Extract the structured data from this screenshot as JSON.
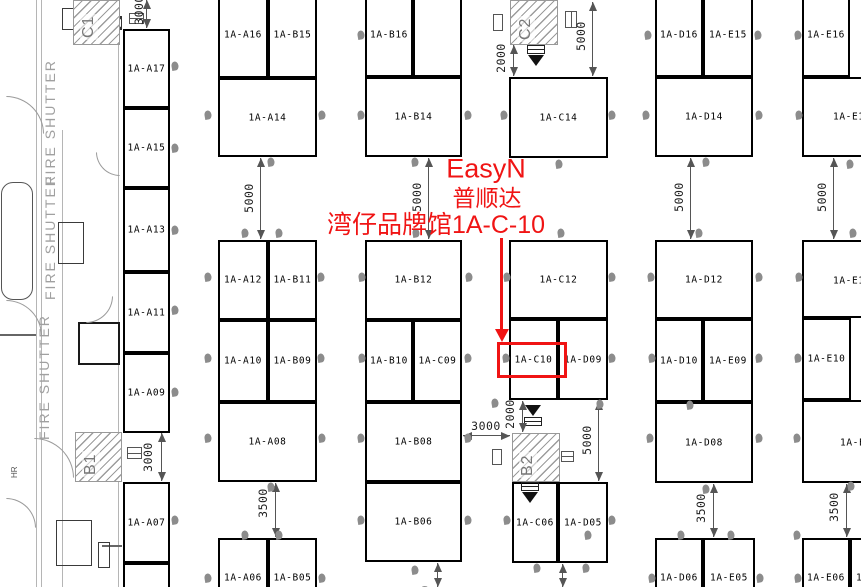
{
  "annotation": {
    "color": "#f01414",
    "lines": [
      {
        "text": "EasyN",
        "cx": 486,
        "cy": 169,
        "fs": 27
      },
      {
        "text": "普顺达",
        "cx": 487,
        "cy": 196,
        "fs": 23
      },
      {
        "text": "湾仔品牌馆1A-C-10",
        "cx": 436,
        "cy": 223,
        "fs": 25
      }
    ],
    "arrow": {
      "x": 500,
      "y1": 238,
      "y2": 330
    },
    "rect": {
      "x": 497,
      "y": 342,
      "w": 70,
      "h": 36
    },
    "highlight_booth": "1A-C10"
  },
  "fire_shutter_label": "FIRE SHUTTER",
  "fire_shutters": [
    {
      "x": 42,
      "y": 185
    },
    {
      "x": 42,
      "y": 300
    },
    {
      "x": 36,
      "y": 440
    }
  ],
  "hr": {
    "x": 10,
    "y": 478,
    "label": "HR"
  },
  "rooms": [
    {
      "label": "C1",
      "x": 73,
      "y": 0,
      "w": 47,
      "h": 45,
      "lx": 80,
      "ly": 40
    },
    {
      "label": "C2",
      "x": 510,
      "y": 0,
      "w": 48,
      "h": 45,
      "lx": 517,
      "ly": 42
    },
    {
      "label": "B1",
      "x": 75,
      "y": 432,
      "w": 47,
      "h": 50,
      "lx": 82,
      "ly": 477
    },
    {
      "label": "B2",
      "x": 512,
      "y": 433,
      "w": 48,
      "h": 49,
      "lx": 519,
      "ly": 478
    }
  ],
  "booths": [
    {
      "label": "1A-A17",
      "x": 123,
      "y": 29,
      "w": 47,
      "h": 79
    },
    {
      "label": "1A-A15",
      "x": 123,
      "y": 108,
      "w": 47,
      "h": 80
    },
    {
      "label": "1A-A13",
      "x": 123,
      "y": 188,
      "w": 47,
      "h": 84
    },
    {
      "label": "1A-A11",
      "x": 123,
      "y": 272,
      "w": 47,
      "h": 81
    },
    {
      "label": "1A-A09",
      "x": 123,
      "y": 353,
      "w": 47,
      "h": 80
    },
    {
      "label": "1A-A07",
      "x": 123,
      "y": 482,
      "w": 47,
      "h": 81
    },
    {
      "label": "",
      "x": 123,
      "y": 563,
      "w": 47,
      "h": 40
    },
    {
      "label": "1A-A16",
      "x": 218,
      "y": -8,
      "w": 50,
      "h": 86
    },
    {
      "label": "1A-B15",
      "x": 268,
      "y": -8,
      "w": 49,
      "h": 86
    },
    {
      "label": "1A-A14",
      "x": 218,
      "y": 78,
      "w": 99,
      "h": 79
    },
    {
      "label": "1A-A12",
      "x": 218,
      "y": 240,
      "w": 50,
      "h": 80
    },
    {
      "label": "1A-B11",
      "x": 268,
      "y": 240,
      "w": 49,
      "h": 80
    },
    {
      "label": "1A-A10",
      "x": 218,
      "y": 320,
      "w": 50,
      "h": 82
    },
    {
      "label": "1A-B09",
      "x": 268,
      "y": 320,
      "w": 49,
      "h": 82
    },
    {
      "label": "1A-A08",
      "x": 218,
      "y": 402,
      "w": 99,
      "h": 80
    },
    {
      "label": "1A-A06",
      "x": 218,
      "y": 538,
      "w": 50,
      "h": 60,
      "ly": 578
    },
    {
      "label": "1A-B05",
      "x": 268,
      "y": 538,
      "w": 49,
      "h": 60,
      "ly": 578
    },
    {
      "label": "1A-B16",
      "x": 365,
      "y": -8,
      "w": 48,
      "h": 85
    },
    {
      "label": "",
      "x": 413,
      "y": -8,
      "w": 49,
      "h": 85
    },
    {
      "label": "1A-B14",
      "x": 365,
      "y": 77,
      "w": 97,
      "h": 80
    },
    {
      "label": "1A-B12",
      "x": 365,
      "y": 240,
      "w": 97,
      "h": 80
    },
    {
      "label": "1A-B10",
      "x": 365,
      "y": 320,
      "w": 48,
      "h": 82
    },
    {
      "label": "1A-C09",
      "x": 413,
      "y": 320,
      "w": 49,
      "h": 82
    },
    {
      "label": "1A-B08",
      "x": 365,
      "y": 402,
      "w": 97,
      "h": 80
    },
    {
      "label": "1A-B06",
      "x": 365,
      "y": 482,
      "w": 97,
      "h": 80
    },
    {
      "label": "1A-C14",
      "x": 509,
      "y": 77,
      "w": 99,
      "h": 81
    },
    {
      "label": "1A-C12",
      "x": 509,
      "y": 240,
      "w": 99,
      "h": 79
    },
    {
      "label": "1A-C10",
      "x": 509,
      "y": 319,
      "w": 49,
      "h": 81
    },
    {
      "label": "1A-D09",
      "x": 558,
      "y": 319,
      "w": 50,
      "h": 81
    },
    {
      "label": "1A-C06",
      "x": 512,
      "y": 482,
      "w": 46,
      "h": 81
    },
    {
      "label": "1A-D05",
      "x": 558,
      "y": 482,
      "w": 50,
      "h": 81
    },
    {
      "label": "1A-D16",
      "x": 655,
      "y": -8,
      "w": 48,
      "h": 85
    },
    {
      "label": "1A-E15",
      "x": 703,
      "y": -8,
      "w": 50,
      "h": 85
    },
    {
      "label": "1A-D14",
      "x": 655,
      "y": 77,
      "w": 98,
      "h": 80
    },
    {
      "label": "1A-D12",
      "x": 655,
      "y": 240,
      "w": 98,
      "h": 79
    },
    {
      "label": "1A-D10",
      "x": 655,
      "y": 319,
      "w": 48,
      "h": 83
    },
    {
      "label": "1A-E09",
      "x": 703,
      "y": 319,
      "w": 50,
      "h": 83
    },
    {
      "label": "1A-D08",
      "x": 655,
      "y": 402,
      "w": 98,
      "h": 81
    },
    {
      "label": "1A-D06",
      "x": 655,
      "y": 538,
      "w": 48,
      "h": 60,
      "ly": 578
    },
    {
      "label": "1A-E05",
      "x": 703,
      "y": 538,
      "w": 52,
      "h": 60,
      "ly": 578
    },
    {
      "label": "1A-E16",
      "x": 802,
      "y": -8,
      "w": 48,
      "h": 85
    },
    {
      "label": "1A-E1",
      "x": 802,
      "y": 77,
      "w": 90,
      "h": 80,
      "lx": 833,
      "ly": 117
    },
    {
      "label": "1A-E1",
      "x": 802,
      "y": 240,
      "w": 90,
      "h": 78,
      "lx": 833,
      "ly": 281
    },
    {
      "label": "1A-E10",
      "x": 802,
      "y": 318,
      "w": 49,
      "h": 82
    },
    {
      "label": "1A-E0",
      "x": 802,
      "y": 400,
      "w": 90,
      "h": 83,
      "lx": 840,
      "ly": 443
    },
    {
      "label": "1A-E06",
      "x": 802,
      "y": 538,
      "w": 48,
      "h": 60,
      "ly": 578
    },
    {
      "label": "1",
      "x": 850,
      "y": 538,
      "w": 45,
      "h": 60,
      "lx": 856,
      "ly": 578
    }
  ],
  "dimensions": [
    {
      "o": "v",
      "x": 146,
      "y1": 0,
      "y2": 28,
      "label": "3000",
      "tx": 139,
      "ty": 10
    },
    {
      "o": "v",
      "x": 260,
      "y1": 158,
      "y2": 239,
      "label": "5000",
      "tx": 249,
      "ty": 198
    },
    {
      "o": "v",
      "x": 428,
      "y1": 158,
      "y2": 239,
      "label": "5000",
      "tx": 417,
      "ty": 197
    },
    {
      "o": "v",
      "x": 592,
      "y1": 2,
      "y2": 76,
      "label": "5000",
      "tx": 581,
      "ty": 36
    },
    {
      "o": "v",
      "x": 513,
      "y1": 45,
      "y2": 76,
      "label": "2000",
      "tx": 501,
      "ty": 58
    },
    {
      "o": "v",
      "x": 690,
      "y1": 158,
      "y2": 239,
      "label": "5000",
      "tx": 679,
      "ty": 197
    },
    {
      "o": "v",
      "x": 833,
      "y1": 158,
      "y2": 239,
      "label": "5000",
      "tx": 822,
      "ty": 197
    },
    {
      "o": "v",
      "x": 161,
      "y1": 433,
      "y2": 481,
      "label": "3000",
      "tx": 148,
      "ty": 457
    },
    {
      "o": "h",
      "y": 435,
      "x1": 463,
      "x2": 510,
      "label": "3000",
      "tx": 486,
      "ty": 426
    },
    {
      "o": "v",
      "x": 522,
      "y1": 401,
      "y2": 432,
      "label": "2000",
      "tx": 510,
      "ty": 414
    },
    {
      "o": "v",
      "x": 598,
      "y1": 401,
      "y2": 481,
      "label": "5000",
      "tx": 587,
      "ty": 440
    },
    {
      "o": "v",
      "x": 275,
      "y1": 483,
      "y2": 537,
      "label": "3500",
      "tx": 263,
      "ty": 503
    },
    {
      "o": "v",
      "x": 713,
      "y1": 484,
      "y2": 537,
      "label": "3500",
      "tx": 701,
      "ty": 508
    },
    {
      "o": "v",
      "x": 846,
      "y1": 484,
      "y2": 537,
      "label": "3500",
      "tx": 834,
      "ty": 507
    },
    {
      "o": "v",
      "x": 437,
      "y1": 563,
      "y2": 587,
      "label": "3500",
      "tx": 425,
      "ty": 600
    },
    {
      "o": "v",
      "x": 562,
      "y1": 564,
      "y2": 587,
      "label": "3500",
      "tx": 550,
      "ty": 601
    }
  ],
  "markers": [
    [
      361,
      35
    ],
    [
      648,
      35
    ],
    [
      758,
      35
    ],
    [
      798,
      35
    ],
    [
      175,
      66
    ],
    [
      175,
      148
    ],
    [
      175,
      230
    ],
    [
      175,
      310
    ],
    [
      175,
      392
    ],
    [
      175,
      520
    ],
    [
      208,
      115
    ],
    [
      322,
      115
    ],
    [
      361,
      115
    ],
    [
      468,
      115
    ],
    [
      504,
      115
    ],
    [
      612,
      115
    ],
    [
      646,
      115
    ],
    [
      759,
      115
    ],
    [
      799,
      115
    ],
    [
      271,
      162
    ],
    [
      415,
      162
    ],
    [
      559,
      164
    ],
    [
      706,
      162
    ],
    [
      850,
      164
    ],
    [
      245,
      233
    ],
    [
      279,
      233
    ],
    [
      416,
      233
    ],
    [
      561,
      233
    ],
    [
      699,
      233
    ],
    [
      853,
      233
    ],
    [
      208,
      277
    ],
    [
      321,
      277
    ],
    [
      362,
      277
    ],
    [
      469,
      277
    ],
    [
      507,
      277
    ],
    [
      612,
      277
    ],
    [
      651,
      277
    ],
    [
      759,
      277
    ],
    [
      799,
      277
    ],
    [
      208,
      358
    ],
    [
      321,
      358
    ],
    [
      362,
      358
    ],
    [
      468,
      358
    ],
    [
      506,
      358
    ],
    [
      612,
      358
    ],
    [
      652,
      358
    ],
    [
      759,
      358
    ],
    [
      798,
      358
    ],
    [
      495,
      403
    ],
    [
      600,
      404
    ],
    [
      690,
      405
    ],
    [
      208,
      438
    ],
    [
      322,
      438
    ],
    [
      361,
      438
    ],
    [
      468,
      438
    ],
    [
      650,
      438
    ],
    [
      759,
      438
    ],
    [
      797,
      438
    ],
    [
      271,
      487
    ],
    [
      706,
      489
    ],
    [
      851,
      486
    ],
    [
      245,
      535
    ],
    [
      279,
      535
    ],
    [
      588,
      535
    ],
    [
      681,
      535
    ],
    [
      731,
      535
    ],
    [
      797,
      535
    ],
    [
      361,
      520
    ],
    [
      468,
      520
    ],
    [
      507,
      520
    ],
    [
      612,
      520
    ],
    [
      415,
      570
    ],
    [
      537,
      568
    ],
    [
      586,
      568
    ],
    [
      208,
      578
    ],
    [
      322,
      578
    ],
    [
      652,
      578
    ],
    [
      760,
      578
    ],
    [
      798,
      578
    ]
  ],
  "fixtures": [
    {
      "t": "vline",
      "x": 36,
      "y": 0,
      "h": 587
    },
    {
      "t": "vline",
      "x": 41,
      "y": 0,
      "h": 587
    },
    {
      "t": "vline",
      "x": 62,
      "y": 130,
      "h": 457
    },
    {
      "t": "vline",
      "x": 118,
      "y": 0,
      "h": 587
    },
    {
      "t": "hline",
      "x": 0,
      "y": 334,
      "w": 36
    },
    {
      "t": "hline",
      "x": 102,
      "y": 545,
      "w": 20
    },
    {
      "t": "box",
      "x": 62,
      "y": 8,
      "w": 32,
      "h": 22
    },
    {
      "t": "box",
      "x": 58,
      "y": 222,
      "w": 26,
      "h": 42
    },
    {
      "t": "box",
      "x": 56,
      "y": 520,
      "w": 36,
      "h": 46
    },
    {
      "t": "box",
      "x": 98,
      "y": 542,
      "w": 12,
      "h": 26
    },
    {
      "t": "round",
      "x": 1,
      "y": 182,
      "w": 32,
      "h": 118
    },
    {
      "t": "sq",
      "x": 78,
      "y": 322,
      "w": 42,
      "h": 43
    },
    {
      "t": "arc",
      "x": 6,
      "y": 96,
      "r": 38,
      "o": "tr"
    },
    {
      "t": "arc",
      "x": 6,
      "y": 300,
      "r": 36,
      "o": "tr"
    },
    {
      "t": "arc",
      "x": 86,
      "y": 296,
      "r": 27,
      "o": "br"
    },
    {
      "t": "arc",
      "x": 34,
      "y": 438,
      "r": 40,
      "o": "tr"
    },
    {
      "t": "arc",
      "x": 96,
      "y": 152,
      "r": 24,
      "o": "bl"
    },
    {
      "t": "arc",
      "x": 6,
      "y": 498,
      "r": 30,
      "o": "tr"
    },
    {
      "t": "sign",
      "x": 493,
      "y": 14,
      "w": 10,
      "h": 17
    },
    {
      "t": "sign",
      "x": 492,
      "y": 449,
      "w": 10,
      "h": 16
    },
    {
      "t": "table",
      "x": 129,
      "y": 13,
      "w": 15,
      "h": 11
    },
    {
      "t": "table",
      "x": 565,
      "y": 11,
      "w": 12,
      "h": 17,
      "v": 1
    },
    {
      "t": "table",
      "x": 127,
      "y": 447,
      "w": 15,
      "h": 12
    },
    {
      "t": "table",
      "x": 561,
      "y": 451,
      "w": 13,
      "h": 11
    },
    {
      "t": "doorx",
      "x": 109,
      "y": 16,
      "w": 13,
      "h": 14
    },
    {
      "t": "doorx",
      "x": 109,
      "y": 449,
      "w": 12,
      "h": 14
    },
    {
      "t": "doorleaf",
      "x": 543,
      "y": 13,
      "w": 11,
      "h": 22
    },
    {
      "t": "doorleaf",
      "x": 543,
      "y": 448,
      "w": 11,
      "h": 20
    },
    {
      "t": "av",
      "x": 524,
      "y": 45,
      "tri": "bottom"
    },
    {
      "t": "av",
      "x": 521,
      "y": 404,
      "tri": "top"
    },
    {
      "t": "av",
      "x": 518,
      "y": 482,
      "tri": "bottom"
    }
  ]
}
